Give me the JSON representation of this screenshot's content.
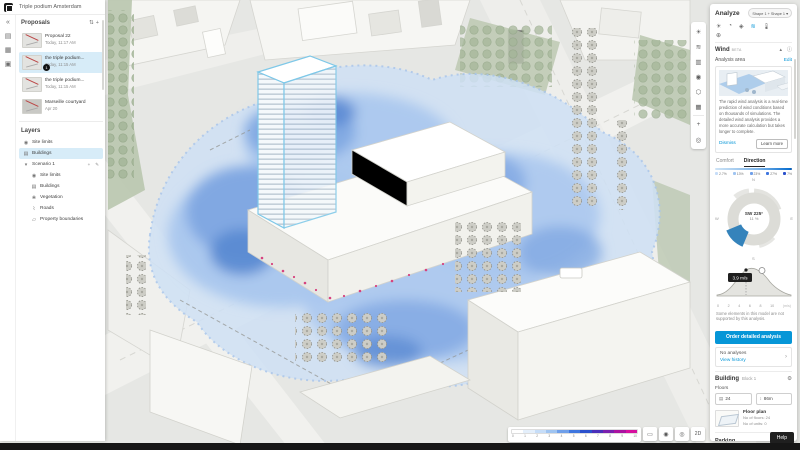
{
  "app": {
    "title": "Triple podium Amsterdam"
  },
  "sidebar": {
    "proposals": {
      "header": "Proposals",
      "sort_icon": "sort-icon",
      "add_icon": "plus-icon",
      "items": [
        {
          "title": "Proposal 22",
          "time": "Today, 11:17 AM"
        },
        {
          "title": "the triple podium...",
          "time": "Today, 11:15 AM",
          "badge": "1"
        },
        {
          "title": "the triple podium...",
          "time": "Today, 11:15 AM"
        },
        {
          "title": "Marseille courtyard",
          "time": "Apr 20"
        }
      ]
    },
    "layers": {
      "header": "Layers",
      "top": [
        {
          "label": "Site limits"
        },
        {
          "label": "Buildings"
        },
        {
          "label": "Scenario 1"
        }
      ],
      "children": [
        {
          "label": "Site limits"
        },
        {
          "label": "Buildings"
        },
        {
          "label": "Vegetation"
        },
        {
          "label": "Roads"
        },
        {
          "label": "Property boundaries"
        }
      ]
    }
  },
  "analyze": {
    "title": "Analyze",
    "scope": "Shape 1 + Shape 1",
    "wind": {
      "label": "Wind",
      "badge": "BETA"
    },
    "analysis_area": {
      "label": "Analysis area",
      "action": "Edit"
    },
    "info_card": {
      "text": "The rapid wind analysis is a real-time prediction of wind conditions based on thousands of simulations. The detailed wind analysis provides a more accurate calculation but takes longer to complete.",
      "dismiss": "Dismiss",
      "learn_more": "Learn more"
    },
    "tabs": [
      {
        "label": "Comfort"
      },
      {
        "label": "Direction"
      }
    ],
    "direction_chips": [
      {
        "value": "2.7%"
      },
      {
        "value": "13%"
      },
      {
        "value": "23%"
      },
      {
        "value": "27%"
      },
      {
        "value": "7%"
      }
    ],
    "wind_rose": {
      "direction": "SW 225°",
      "share": "11 %",
      "compass": [
        "N",
        "E",
        "S",
        "W"
      ]
    },
    "histogram": {
      "tooltip": "3.9 m/s",
      "x_ticks": [
        "0",
        "2",
        "4",
        "6",
        "8",
        "10"
      ],
      "x_unit": "(m/s)"
    },
    "note": "Some elements in this model are not supported by this analysis.",
    "detailed_button": "Order detailed analysis",
    "history": {
      "empty": "No analyses",
      "link": "View history"
    },
    "building": {
      "label": "Building",
      "name": "Block 1",
      "floors_label": "Floors",
      "floors_value": "24",
      "height_value": "86m",
      "floor_plan": {
        "title": "Floor plan",
        "line1": "No of floors: 24",
        "line2": "No of units: 0"
      }
    },
    "parking": {
      "label": "Parking"
    },
    "function": {
      "label": "Function"
    },
    "help": "Help"
  },
  "canvas_ui": {
    "legend": {
      "ticks": [
        "0",
        "1",
        "2",
        "3",
        "4",
        "5",
        "6",
        "7",
        "8",
        "9",
        "10"
      ],
      "colors": [
        "#ffffff",
        "#e4effb",
        "#c6ddf8",
        "#9fc4f1",
        "#6f9fe9",
        "#3f76df",
        "#2b50cc",
        "#4a2fb9",
        "#7a1fae",
        "#aa12a0",
        "#d60f9e"
      ]
    },
    "accent": "#0696d7"
  }
}
